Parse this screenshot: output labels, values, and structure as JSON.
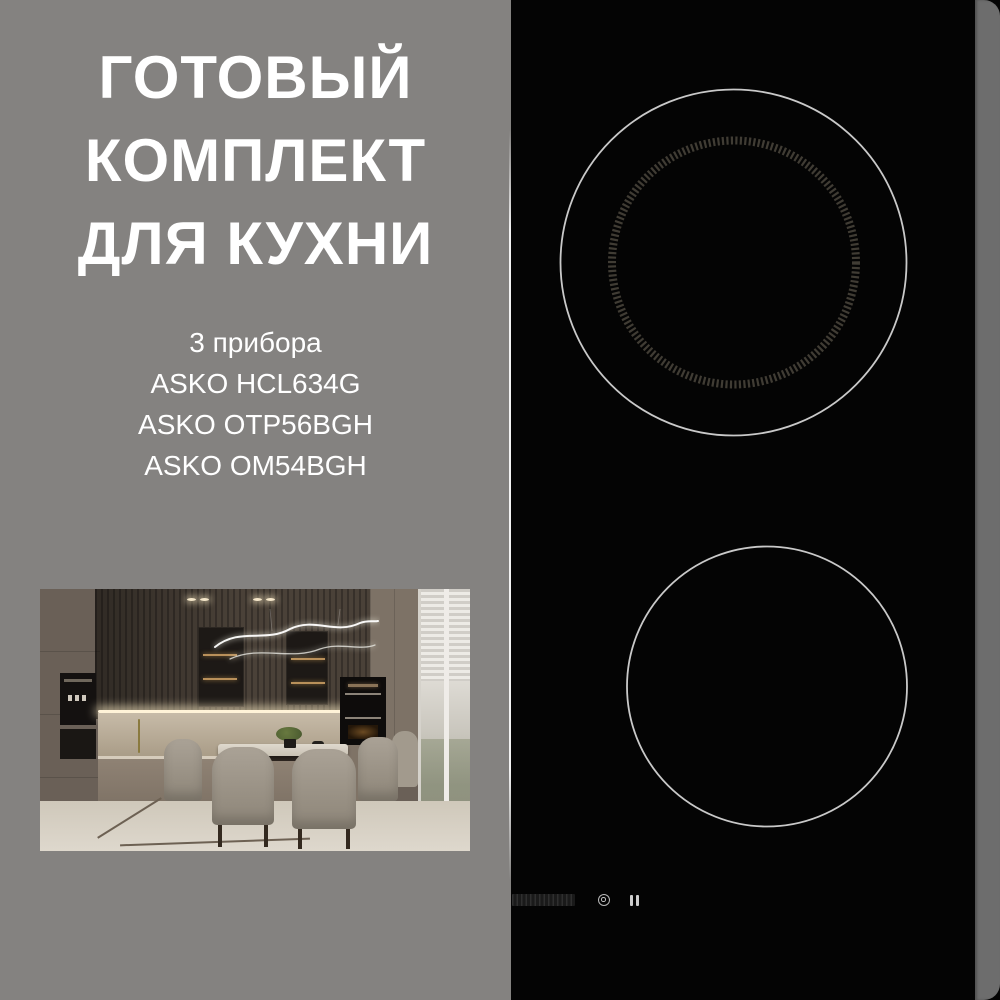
{
  "left_panel": {
    "title_lines": [
      "ГОТОВЫЙ",
      "КОМПЛЕКТ",
      "ДЛЯ КУХНИ"
    ],
    "subtitle": "3 прибора",
    "products": [
      "ASKO HCL634G",
      "ASKO OTP56BGH",
      "ASKO OM54BGH"
    ]
  },
  "cooktop": {
    "burner_count": 2,
    "icons": [
      "touch-slider-icon",
      "burner-target-icon",
      "pause-icon"
    ]
  },
  "colors": {
    "background_gray": "#848280",
    "edge_gray": "#6d6d6d",
    "cooktop_black": "#040404",
    "burner_outline": "#c9c9c9",
    "burner_ticks": "#403c34",
    "title_text": "#ffffff"
  }
}
